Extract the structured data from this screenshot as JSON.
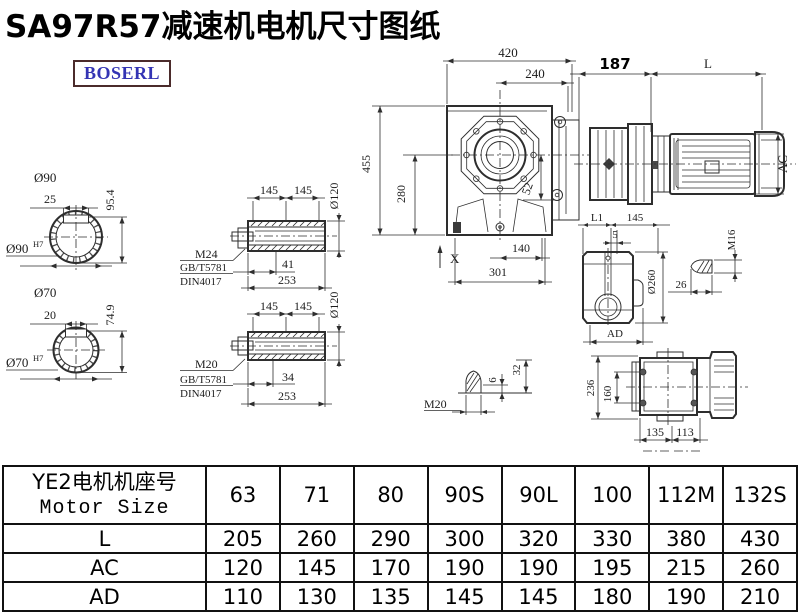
{
  "page": {
    "title": "SA97R57减速机电机尺寸图纸",
    "logo_text": "BOSERL"
  },
  "dims": {
    "shaft_top": {
      "dia": "Ø90",
      "key": "25",
      "height": "95.4",
      "fit": "Ø90",
      "fit_tol": "H7"
    },
    "shaft_bottom": {
      "dia": "Ø70",
      "key": "20",
      "height": "74.9",
      "fit": "Ø70",
      "fit_tol": "H7"
    },
    "hollow_top": {
      "l1": "145",
      "l2": "145",
      "dia": "Ø120",
      "thread": "M24",
      "std1": "GB/T5781",
      "std2": "DIN4017",
      "depth": "41",
      "total": "253"
    },
    "hollow_bottom": {
      "l1": "145",
      "l2": "145",
      "dia": "Ø120",
      "thread": "M20",
      "std1": "GB/T5781",
      "std2": "DIN4017",
      "depth": "34",
      "total": "253"
    },
    "front": {
      "width": "420",
      "top_width": "240",
      "height": "455",
      "lower_height": "280",
      "offset": "52",
      "x_mark": "X",
      "foot": "140",
      "base": "301"
    },
    "motor": {
      "adapter": "187",
      "length": "L",
      "ac": "AC"
    },
    "side": {
      "l1": "L1",
      "d145": "145",
      "d5": "5",
      "dia": "Ø260",
      "ad": "AD"
    },
    "bolt_m16": {
      "thread": "M16",
      "length": "26"
    },
    "bolt_m20": {
      "thread": "M20",
      "d6": "6",
      "d32": "32"
    },
    "bottom": {
      "height": "236",
      "spacing": "160",
      "left": "135",
      "right": "113"
    }
  },
  "table": {
    "header_cn": "YE2电机机座号",
    "header_en": "Motor Size",
    "columns": [
      "63",
      "71",
      "80",
      "90S",
      "90L",
      "100",
      "112M",
      "132S"
    ],
    "rows": [
      {
        "label": "L",
        "values": [
          "205",
          "260",
          "290",
          "300",
          "320",
          "330",
          "380",
          "430"
        ]
      },
      {
        "label": "AC",
        "values": [
          "120",
          "145",
          "170",
          "190",
          "190",
          "195",
          "215",
          "260"
        ]
      },
      {
        "label": "AD",
        "values": [
          "110",
          "130",
          "135",
          "145",
          "145",
          "180",
          "190",
          "210"
        ]
      }
    ]
  }
}
